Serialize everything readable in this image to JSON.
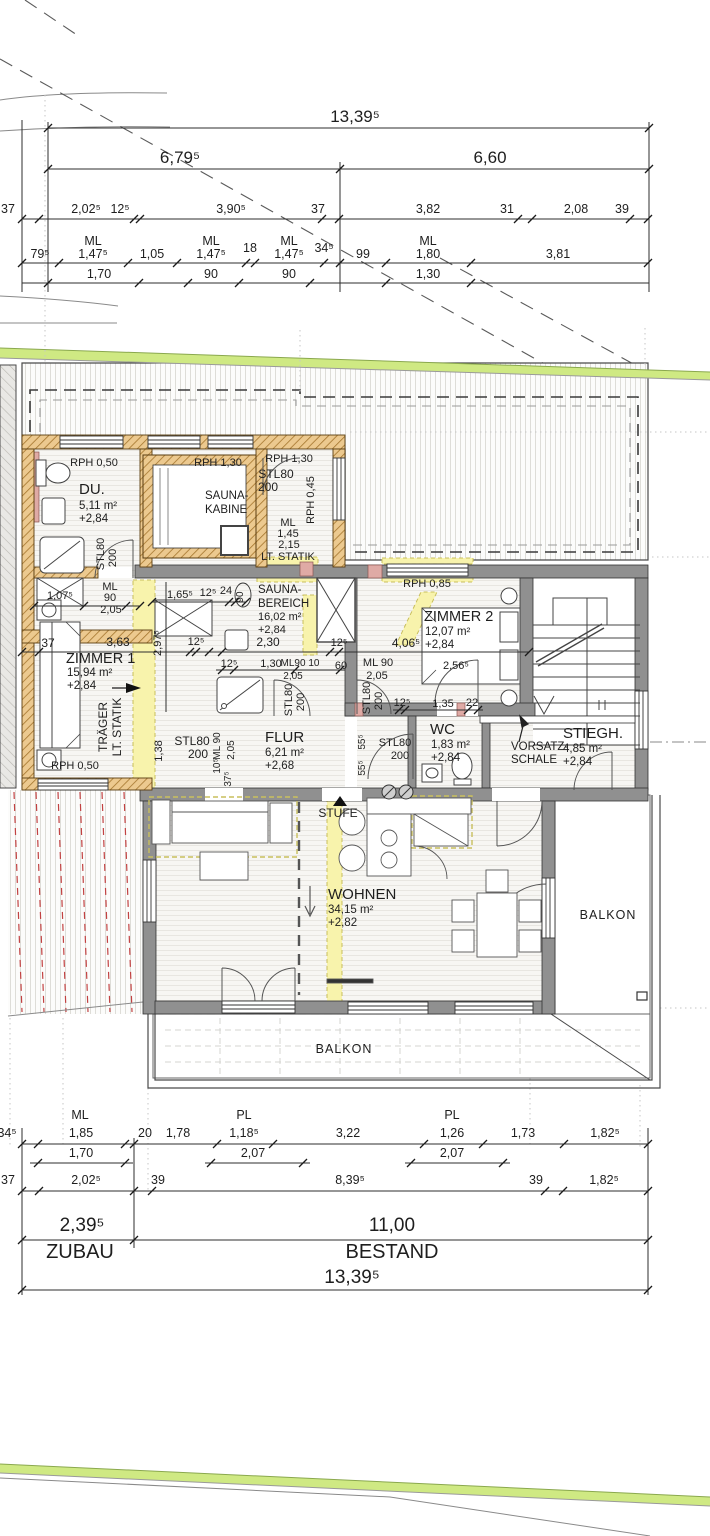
{
  "drawing": {
    "kind": "floor-plan",
    "zones": [
      {
        "label": "ZUBAU",
        "width": "2,39⁵"
      },
      {
        "label": "BESTAND",
        "width": "11,00"
      },
      {
        "label": "total",
        "width": "13,39⁵"
      }
    ],
    "rooms": [
      {
        "name": "DU.",
        "area": "5,11 m²",
        "level": "+2,84"
      },
      {
        "name": "SAUNA-KABINE",
        "area": "",
        "level": ""
      },
      {
        "name": "SAUNA-BEREICH",
        "area": "16,02 m²",
        "level": "+2,84"
      },
      {
        "name": "ZIMMER 1",
        "area": "15,94 m²",
        "level": "+2,84"
      },
      {
        "name": "ZIMMER 2",
        "area": "12,07 m²",
        "level": "+2,84"
      },
      {
        "name": "FLUR",
        "area": "6,21 m²",
        "level": "+2,68"
      },
      {
        "name": "WC",
        "area": "1,83 m²",
        "level": "+2,84"
      },
      {
        "name": "STIEGH.",
        "area": "4,85 m²",
        "level": "+2,84"
      },
      {
        "name": "WOHNEN",
        "area": "34,15 m²",
        "level": "+2,82"
      },
      {
        "name": "BALKON",
        "area": "",
        "level": ""
      },
      {
        "name": "BALKON",
        "area": "",
        "level": ""
      }
    ],
    "colors": {
      "terrain": "#cfe983",
      "newWall": "#ecc98f",
      "existingWall": "#909090",
      "highlight": "#f8f3ac",
      "roofRed": "#c24242",
      "pink": "#dfaaa5"
    }
  },
  "labels": [
    {
      "t": "13,39⁵",
      "x": 355,
      "y": 122,
      "s": 17
    },
    {
      "t": "6,79⁵",
      "x": 180,
      "y": 163,
      "s": 17
    },
    {
      "t": "6,60",
      "x": 490,
      "y": 163,
      "s": 17
    },
    {
      "t": "37",
      "x": 8,
      "y": 213,
      "s": 12.5
    },
    {
      "t": "2,02⁵",
      "x": 86,
      "y": 213,
      "s": 12.5
    },
    {
      "t": "12⁵",
      "x": 120,
      "y": 213,
      "s": 12.5
    },
    {
      "t": "3,90⁵",
      "x": 231,
      "y": 213,
      "s": 12.5
    },
    {
      "t": "37",
      "x": 318,
      "y": 213,
      "s": 12.5
    },
    {
      "t": "3,82",
      "x": 428,
      "y": 213,
      "s": 12.5
    },
    {
      "t": "31",
      "x": 507,
      "y": 213,
      "s": 12.5
    },
    {
      "t": "2,08",
      "x": 576,
      "y": 213,
      "s": 12.5
    },
    {
      "t": "39",
      "x": 622,
      "y": 213,
      "s": 12.5
    },
    {
      "t": "79⁵",
      "x": 40,
      "y": 258,
      "s": 12.5
    },
    {
      "t": "ML",
      "x": 93,
      "y": 245,
      "s": 12.5
    },
    {
      "t": "1,47⁵",
      "x": 93,
      "y": 258,
      "s": 12.5
    },
    {
      "t": "1,70",
      "x": 99,
      "y": 278,
      "s": 12.5
    },
    {
      "t": "1,05",
      "x": 152,
      "y": 258,
      "s": 12.5
    },
    {
      "t": "ML",
      "x": 211,
      "y": 245,
      "s": 12.5
    },
    {
      "t": "1,47⁵",
      "x": 211,
      "y": 258,
      "s": 12.5
    },
    {
      "t": "90",
      "x": 211,
      "y": 278,
      "s": 12.5
    },
    {
      "t": "18",
      "x": 250,
      "y": 252,
      "s": 12.5
    },
    {
      "t": "ML",
      "x": 289,
      "y": 245,
      "s": 12.5
    },
    {
      "t": "1,47⁵",
      "x": 289,
      "y": 258,
      "s": 12.5
    },
    {
      "t": "90",
      "x": 289,
      "y": 278,
      "s": 12.5
    },
    {
      "t": "34⁵",
      "x": 324,
      "y": 252,
      "s": 12.5
    },
    {
      "t": "99",
      "x": 363,
      "y": 258,
      "s": 12.5
    },
    {
      "t": "ML",
      "x": 428,
      "y": 245,
      "s": 12.5
    },
    {
      "t": "1,80",
      "x": 428,
      "y": 258,
      "s": 12.5
    },
    {
      "t": "1,30",
      "x": 428,
      "y": 278,
      "s": 12.5
    },
    {
      "t": "3,81",
      "x": 558,
      "y": 258,
      "s": 12.5
    },
    {
      "t": "RPH 0,50",
      "x": 94,
      "y": 466,
      "s": 11
    },
    {
      "t": "DU.",
      "x": 79,
      "y": 494,
      "s": 15,
      "a": "s",
      "n": "room-label-du"
    },
    {
      "t": "5,11 m²",
      "x": 79,
      "y": 509,
      "a": "s"
    },
    {
      "t": "+2,84",
      "x": 79,
      "y": 522,
      "a": "s"
    },
    {
      "t": "RPH 1,30",
      "x": 218,
      "y": 466,
      "s": 11
    },
    {
      "t": "SAUNA-",
      "x": 205,
      "y": 499,
      "a": "s",
      "n": "room-label-saunakabine"
    },
    {
      "t": "KABINE",
      "x": 205,
      "y": 513,
      "a": "s"
    },
    {
      "t": "RPH 1,30",
      "x": 289,
      "y": 462,
      "s": 11
    },
    {
      "t": "STL80",
      "x": 276,
      "y": 478,
      "s": 12
    },
    {
      "t": "200",
      "x": 268,
      "y": 491,
      "s": 12
    },
    {
      "t": "RPH 0,45",
      "x": 314,
      "y": 500,
      "s": 11,
      "r": -90
    },
    {
      "t": "ML",
      "x": 288,
      "y": 526,
      "s": 11
    },
    {
      "t": "1,45",
      "x": 288,
      "y": 537,
      "s": 11
    },
    {
      "t": "2,15",
      "x": 289,
      "y": 548,
      "s": 11
    },
    {
      "t": "LT. STATIK",
      "x": 288,
      "y": 560,
      "s": 11
    },
    {
      "t": "STL80",
      "x": 104,
      "y": 554,
      "s": 11,
      "r": -90
    },
    {
      "t": "200",
      "x": 116,
      "y": 558,
      "s": 11,
      "r": -90
    },
    {
      "t": "1,07⁵",
      "x": 60,
      "y": 599,
      "s": 11
    },
    {
      "t": "ML",
      "x": 110,
      "y": 590,
      "s": 11
    },
    {
      "t": "90",
      "x": 110,
      "y": 601,
      "s": 11
    },
    {
      "t": "2,05",
      "x": 111,
      "y": 613,
      "s": 11
    },
    {
      "t": "SAUNA-",
      "x": 258,
      "y": 593,
      "a": "s",
      "n": "room-label-saunabereich"
    },
    {
      "t": "BEREICH",
      "x": 258,
      "y": 607,
      "a": "s"
    },
    {
      "t": "16,02 m²",
      "x": 258,
      "y": 620,
      "s": 11,
      "a": "s"
    },
    {
      "t": "+2,84",
      "x": 258,
      "y": 633,
      "s": 11,
      "a": "s"
    },
    {
      "t": "1,65⁵",
      "x": 180,
      "y": 598,
      "s": 11
    },
    {
      "t": "12⁵",
      "x": 208,
      "y": 596,
      "s": 11
    },
    {
      "t": "24",
      "x": 226,
      "y": 594,
      "s": 11
    },
    {
      "t": "90",
      "x": 243,
      "y": 597,
      "s": 10,
      "r": -90
    },
    {
      "t": "2,97⁵",
      "x": 161,
      "y": 643,
      "s": 11,
      "r": -90
    },
    {
      "t": "37",
      "x": 48,
      "y": 647,
      "s": 12
    },
    {
      "t": "3,63",
      "x": 118,
      "y": 646,
      "s": 12
    },
    {
      "t": "12⁵",
      "x": 196,
      "y": 645,
      "s": 11
    },
    {
      "t": "2,30",
      "x": 268,
      "y": 646,
      "s": 12
    },
    {
      "t": "12⁵",
      "x": 339,
      "y": 646,
      "s": 11
    },
    {
      "t": "4,06⁵",
      "x": 406,
      "y": 647,
      "s": 12
    },
    {
      "t": "ZIMMER 1",
      "x": 66,
      "y": 663,
      "s": 14.5,
      "a": "s",
      "n": "room-label-zimmer1"
    },
    {
      "t": "15,94 m²",
      "x": 67,
      "y": 676,
      "a": "s"
    },
    {
      "t": "+2,84",
      "x": 67,
      "y": 689,
      "a": "s"
    },
    {
      "t": "RPH 0,85",
      "x": 427,
      "y": 587,
      "s": 11
    },
    {
      "t": "ZIMMER 2",
      "x": 424,
      "y": 621,
      "s": 14.5,
      "a": "s",
      "n": "room-label-zimmer2"
    },
    {
      "t": "12,07 m²",
      "x": 425,
      "y": 635,
      "a": "s"
    },
    {
      "t": "+2,84",
      "x": 425,
      "y": 648,
      "a": "s"
    },
    {
      "t": "2,56⁵",
      "x": 456,
      "y": 669,
      "s": 11
    },
    {
      "t": "12⁵",
      "x": 229,
      "y": 667,
      "s": 11
    },
    {
      "t": "1,30",
      "x": 271,
      "y": 667,
      "s": 11
    },
    {
      "t": "ML90 10",
      "x": 300,
      "y": 666,
      "s": 10
    },
    {
      "t": "2,05",
      "x": 293,
      "y": 679,
      "s": 10
    },
    {
      "t": "60",
      "x": 341,
      "y": 669,
      "s": 11
    },
    {
      "t": "ML 90",
      "x": 378,
      "y": 666,
      "s": 11
    },
    {
      "t": "2,05",
      "x": 377,
      "y": 679,
      "s": 11
    },
    {
      "t": "STL80",
      "x": 370,
      "y": 698,
      "s": 11,
      "r": -90
    },
    {
      "t": "200",
      "x": 382,
      "y": 701,
      "s": 11,
      "r": -90
    },
    {
      "t": "12⁵",
      "x": 402,
      "y": 706,
      "s": 11
    },
    {
      "t": "1,35",
      "x": 443,
      "y": 707,
      "s": 11
    },
    {
      "t": "22",
      "x": 472,
      "y": 706,
      "s": 11
    },
    {
      "t": "TRÄGER",
      "x": 107,
      "y": 727,
      "s": 12,
      "r": -90
    },
    {
      "t": "LT. STATIK",
      "x": 121,
      "y": 727,
      "s": 12,
      "r": -90
    },
    {
      "t": "1,38",
      "x": 162,
      "y": 751,
      "s": 11,
      "r": -90
    },
    {
      "t": "STL80",
      "x": 192,
      "y": 745,
      "s": 12
    },
    {
      "t": "200",
      "x": 198,
      "y": 758,
      "s": 12
    },
    {
      "t": "ML 90",
      "x": 220,
      "y": 746,
      "s": 10,
      "r": -90
    },
    {
      "t": "10⁵",
      "x": 220,
      "y": 766,
      "s": 10,
      "r": -90
    },
    {
      "t": "2,05",
      "x": 234,
      "y": 750,
      "s": 10,
      "r": -90
    },
    {
      "t": "37⁵",
      "x": 231,
      "y": 779,
      "s": 10,
      "r": -90
    },
    {
      "t": "FLUR",
      "x": 265,
      "y": 742,
      "s": 15,
      "a": "s",
      "n": "room-label-flur"
    },
    {
      "t": "6,21 m²",
      "x": 265,
      "y": 756,
      "a": "s"
    },
    {
      "t": "+2,68",
      "x": 265,
      "y": 769,
      "a": "s"
    },
    {
      "t": "STL80",
      "x": 292,
      "y": 700,
      "s": 11,
      "r": -90
    },
    {
      "t": "200",
      "x": 304,
      "y": 702,
      "s": 11,
      "r": -90
    },
    {
      "t": "55⁵",
      "x": 365,
      "y": 742,
      "s": 10,
      "r": -90
    },
    {
      "t": "55⁵",
      "x": 365,
      "y": 768,
      "s": 10,
      "r": -90
    },
    {
      "t": "WC",
      "x": 430,
      "y": 734,
      "s": 15,
      "a": "s",
      "n": "room-label-wc"
    },
    {
      "t": "1,83 m²",
      "x": 431,
      "y": 748,
      "a": "s"
    },
    {
      "t": "+2,84",
      "x": 431,
      "y": 761,
      "a": "s"
    },
    {
      "t": "STL80",
      "x": 395,
      "y": 746,
      "s": 11
    },
    {
      "t": "200",
      "x": 400,
      "y": 759,
      "s": 11
    },
    {
      "t": "VORSATZ-",
      "x": 511,
      "y": 750,
      "a": "s",
      "n": "note-vorsatzschale"
    },
    {
      "t": "SCHALE",
      "x": 511,
      "y": 763,
      "a": "s"
    },
    {
      "t": "STIEGH.",
      "x": 563,
      "y": 738,
      "s": 15,
      "a": "s",
      "n": "room-label-stiegh"
    },
    {
      "t": "4,85 m²",
      "x": 563,
      "y": 752,
      "a": "s"
    },
    {
      "t": "+2,84",
      "x": 563,
      "y": 765,
      "a": "s"
    },
    {
      "t": "RPH 0,50",
      "x": 75,
      "y": 769,
      "s": 11
    },
    {
      "t": "STUFE",
      "x": 338,
      "y": 817,
      "s": 12,
      "n": "note-stufe"
    },
    {
      "t": "WOHNEN",
      "x": 328,
      "y": 899,
      "s": 15,
      "a": "s",
      "n": "room-label-wohnen"
    },
    {
      "t": "34,15 m²",
      "x": 328,
      "y": 913,
      "a": "s"
    },
    {
      "t": "+2,82",
      "x": 328,
      "y": 926,
      "a": "s"
    },
    {
      "t": "BALKON",
      "x": 608,
      "y": 919,
      "s": 12.5,
      "ls": 1,
      "n": "room-label-balkon-ost"
    },
    {
      "t": "BALKON",
      "x": 344,
      "y": 1053,
      "s": 12.5,
      "ls": 1,
      "n": "room-label-balkon-sued"
    },
    {
      "t": "34⁵",
      "x": 7,
      "y": 1137,
      "s": 12.5
    },
    {
      "t": "ML",
      "x": 80,
      "y": 1119,
      "s": 12.5
    },
    {
      "t": "1,85",
      "x": 81,
      "y": 1137,
      "s": 12.5
    },
    {
      "t": "1,70",
      "x": 81,
      "y": 1157,
      "s": 12.5
    },
    {
      "t": "20",
      "x": 145,
      "y": 1137,
      "s": 12.5
    },
    {
      "t": "1,78",
      "x": 178,
      "y": 1137,
      "s": 12.5
    },
    {
      "t": "PL",
      "x": 244,
      "y": 1119,
      "s": 12.5
    },
    {
      "t": "1,18⁵",
      "x": 244,
      "y": 1137,
      "s": 12.5
    },
    {
      "t": "2,07",
      "x": 253,
      "y": 1157,
      "s": 12.5
    },
    {
      "t": "3,22",
      "x": 348,
      "y": 1137,
      "s": 12.5
    },
    {
      "t": "PL",
      "x": 452,
      "y": 1119,
      "s": 12.5
    },
    {
      "t": "1,26",
      "x": 452,
      "y": 1137,
      "s": 12.5
    },
    {
      "t": "2,07",
      "x": 452,
      "y": 1157,
      "s": 12.5
    },
    {
      "t": "1,73",
      "x": 523,
      "y": 1137,
      "s": 12.5
    },
    {
      "t": "1,82⁵",
      "x": 605,
      "y": 1137,
      "s": 12.5
    },
    {
      "t": "37",
      "x": 8,
      "y": 1184,
      "s": 12.5
    },
    {
      "t": "2,02⁵",
      "x": 86,
      "y": 1184,
      "s": 12.5
    },
    {
      "t": "39",
      "x": 158,
      "y": 1184,
      "s": 12.5
    },
    {
      "t": "8,39⁵",
      "x": 350,
      "y": 1184,
      "s": 12.5
    },
    {
      "t": "39",
      "x": 536,
      "y": 1184,
      "s": 12.5
    },
    {
      "t": "1,82⁵",
      "x": 604,
      "y": 1184,
      "s": 12.5
    },
    {
      "t": "2,39⁵",
      "x": 82,
      "y": 1231,
      "s": 19,
      "n": "zone-dim-zubau"
    },
    {
      "t": "11,00",
      "x": 392,
      "y": 1231,
      "s": 19,
      "n": "zone-dim-bestand"
    },
    {
      "t": "ZUBAU",
      "x": 80,
      "y": 1258,
      "s": 20,
      "n": "zone-label-zubau"
    },
    {
      "t": "BESTAND",
      "x": 392,
      "y": 1258,
      "s": 20,
      "n": "zone-label-bestand"
    },
    {
      "t": "13,39⁵",
      "x": 352,
      "y": 1283,
      "s": 19,
      "n": "zone-dim-total"
    }
  ]
}
